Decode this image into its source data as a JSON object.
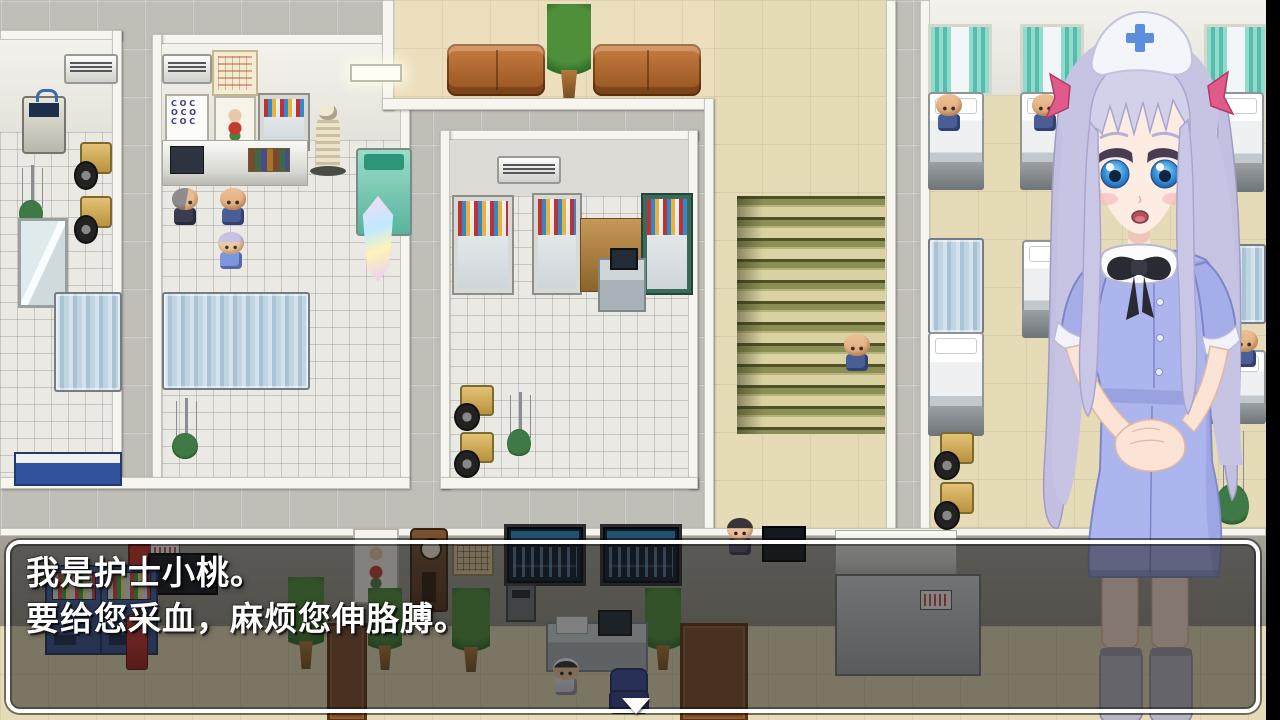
{
  "screen": {
    "width": 1280,
    "height": 720
  },
  "dialogue_box": {
    "lines": [
      "我是护士小桃。",
      "要给您采血，麻烦您伸胳膊。"
    ],
    "continue_indicator": "▼",
    "text_color": "#ffffff",
    "border_color": "#ffffff",
    "background": "rgba(24,24,24,0.52)"
  },
  "portrait": {
    "character": "nurse-bust",
    "hair_color": "#c7c4e3",
    "dress_color": "#adb5ee",
    "cap_color": "#f4f4fb",
    "cap_cross_color": "#5c8ede",
    "eye_color": "#2f8fd6",
    "ribbon_color": "#e05a8a",
    "stocking_color": "#b9b6c4"
  },
  "map_palette": {
    "tile_gray": "#bfbfb7",
    "tile_white": "#eae9e4",
    "floor_beige": "#e5dbb6",
    "stairs_green": "#8b8e55",
    "curtain_teal": "#6fcabb",
    "couch_brown": "#a8602a",
    "vending_blue": "#41619f",
    "privacy_screen_blue": "#bdd4e2",
    "save_crystal": "#e8d8ff",
    "right_letterbox": "#000000"
  }
}
